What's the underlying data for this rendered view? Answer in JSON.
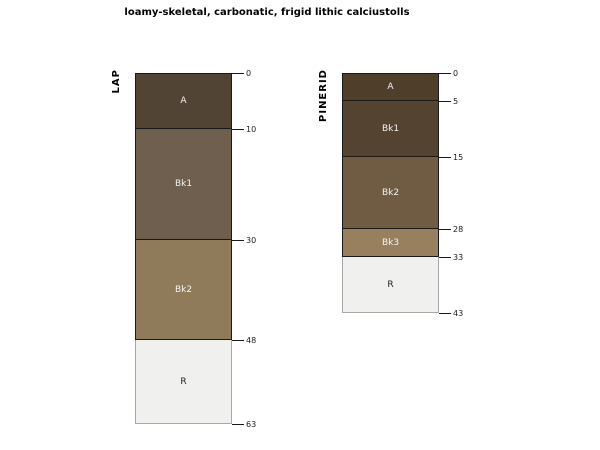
{
  "title": "loamy-skeletal, carbonatic, frigid lithic calciustolls",
  "chart_data": {
    "type": "soil-profile-sketch",
    "depth_units": "cm",
    "px_per_cm": 5.57,
    "profile_top_y": 73,
    "box_width": 97,
    "text_color": "#1a1a1a",
    "profiles": [
      {
        "id": "LAP",
        "box_left": 135,
        "max_depth": 63,
        "depth_ticks": [
          0,
          10,
          30,
          48,
          63
        ],
        "horizons": [
          {
            "name": "A",
            "top": 0,
            "bottom": 10,
            "fill": "#524434",
            "border": "#1a1a1a",
            "label_color": "#f2f2f2"
          },
          {
            "name": "Bk1",
            "top": 10,
            "bottom": 30,
            "fill": "#6e5f4e",
            "border": "#1a1a1a",
            "label_color": "#f2f2f2"
          },
          {
            "name": "Bk2",
            "top": 30,
            "bottom": 48,
            "fill": "#8f7a59",
            "border": "#1a1a1a",
            "label_color": "#f2f2f2"
          },
          {
            "name": "R",
            "top": 48,
            "bottom": 63,
            "fill": "#f0f0ee",
            "border": "#a8a8a8",
            "label_color": "#202020"
          }
        ]
      },
      {
        "id": "PINERID",
        "box_left": 342,
        "max_depth": 43,
        "depth_ticks": [
          0,
          5,
          15,
          28,
          33,
          43
        ],
        "horizons": [
          {
            "name": "A",
            "top": 0,
            "bottom": 5,
            "fill": "#4f3f2a",
            "border": "#1a1a1a",
            "label_color": "#f2f2f2"
          },
          {
            "name": "Bk1",
            "top": 5,
            "bottom": 15,
            "fill": "#544330",
            "border": "#1a1a1a",
            "label_color": "#f2f2f2"
          },
          {
            "name": "Bk2",
            "top": 15,
            "bottom": 28,
            "fill": "#6f5c42",
            "border": "#1a1a1a",
            "label_color": "#f2f2f2"
          },
          {
            "name": "Bk3",
            "top": 28,
            "bottom": 33,
            "fill": "#98805f",
            "border": "#1a1a1a",
            "label_color": "#f2f2f2"
          },
          {
            "name": "R",
            "top": 33,
            "bottom": 43,
            "fill": "#f0f0ee",
            "border": "#a8a8a8",
            "label_color": "#202020"
          }
        ]
      }
    ]
  }
}
